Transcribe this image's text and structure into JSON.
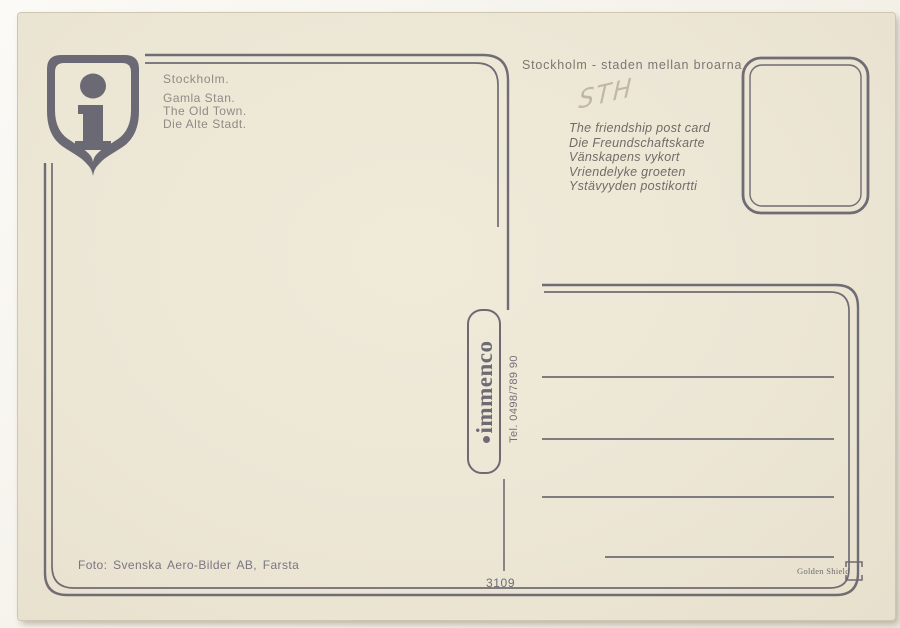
{
  "postcard": {
    "info_block": {
      "city": "Stockholm.",
      "place_lines": [
        "Gamla Stan.",
        "The Old Town.",
        "Die Alte Stadt."
      ]
    },
    "title": "Stockholm - staden mellan broarna",
    "handwritten_note": "STH",
    "greeting_lines": [
      "The friendship post card",
      "Die Freundschaftskarte",
      "Vänskapens vykort",
      "Vriendelyke groeten",
      "Ystävyyden postikortti"
    ],
    "publisher": {
      "name": "immenco",
      "phone": "Tel. 0498/789 90"
    },
    "photo_credit": "Foto: Svenska Aero-Bilder AB, Farsta",
    "card_number": "3109",
    "print_mark": "Golden Shield",
    "icons": {
      "tourist_info": "info-shield-icon"
    },
    "colors": {
      "ink": "#6d6a73",
      "paper": "#ebe5d4",
      "pencil": "#b4ad9f"
    }
  }
}
